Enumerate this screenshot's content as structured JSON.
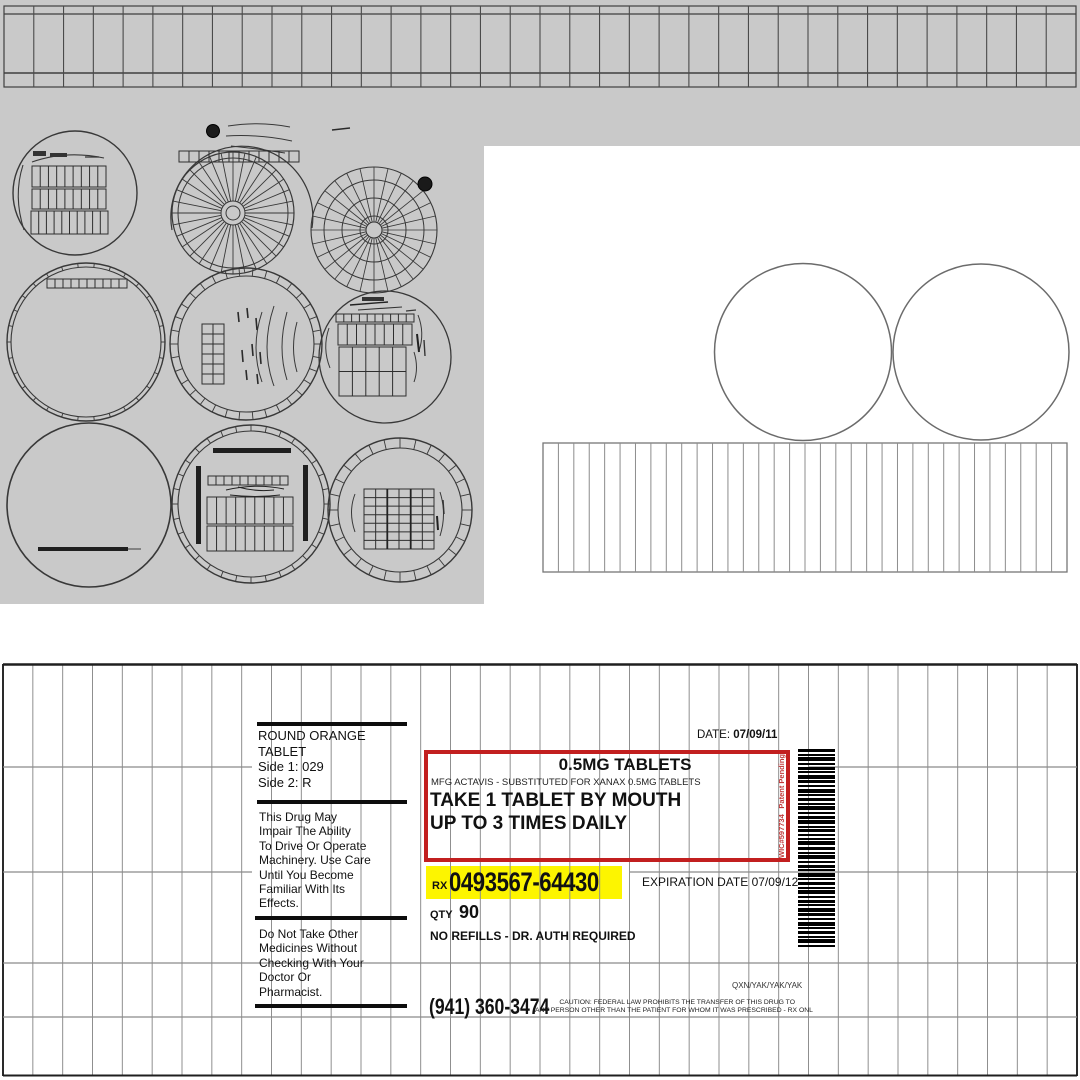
{
  "colors": {
    "canvas_gray": "#c9c9c9",
    "wireframe": "#383838",
    "grid_line": "#8f8f8f",
    "label_border": "#1f1f1f",
    "red_box": "#c21f1f",
    "highlight_yellow": "#fdf500",
    "vertical_note_red": "#c03a3a"
  },
  "label": {
    "date_label": "DATE:",
    "date_value": "07/09/11",
    "pill_description": {
      "lines": [
        "ROUND ORANGE",
        "TABLET",
        "Side 1: 029",
        "Side 2: R"
      ]
    },
    "warning_impairment": {
      "lines": [
        "This Drug May",
        "Impair The Ability",
        "To Drive Or Operate",
        "Machinery. Use Care",
        "Until You Become",
        "Familiar With Its",
        "Effects."
      ]
    },
    "warning_other_medicines": {
      "lines": [
        "Do Not Take Other",
        "Medicines Without",
        "Checking With Your",
        "Doctor Or",
        "Pharmacist."
      ]
    },
    "dosage_box": {
      "strength": "0.5MG TABLETS",
      "mfg_line": "MFG ACTAVIS - SUBSTITUTED FOR XANAX 0.5MG TABLETS",
      "instructions_line1": "TAKE 1 TABLET BY MOUTH",
      "instructions_line2": "UP TO 3 TIMES DAILY",
      "side_note_id": "WIC#597734",
      "side_note_status": "Patent Pending"
    },
    "rx_prefix": "RX",
    "rx_number": "0493567-64430",
    "expiration": "EXPIRATION DATE 07/09/12",
    "qty_label": "QTY",
    "qty_value": "90",
    "refills": "NO REFILLS - DR. AUTH REQUIRED",
    "phone": "(941) 360-3474",
    "code_line": "QXN/YAK/YAK/YAK",
    "caution_line1": "CAUTION: FEDERAL LAW PROHIBITS THE TRANSFER OF THIS DRUG TO",
    "caution_line2": "ANY PERSON OTHER THAN THE PATIENT FOR WHOM IT WAS PRESCRIBED - RX ONL"
  }
}
